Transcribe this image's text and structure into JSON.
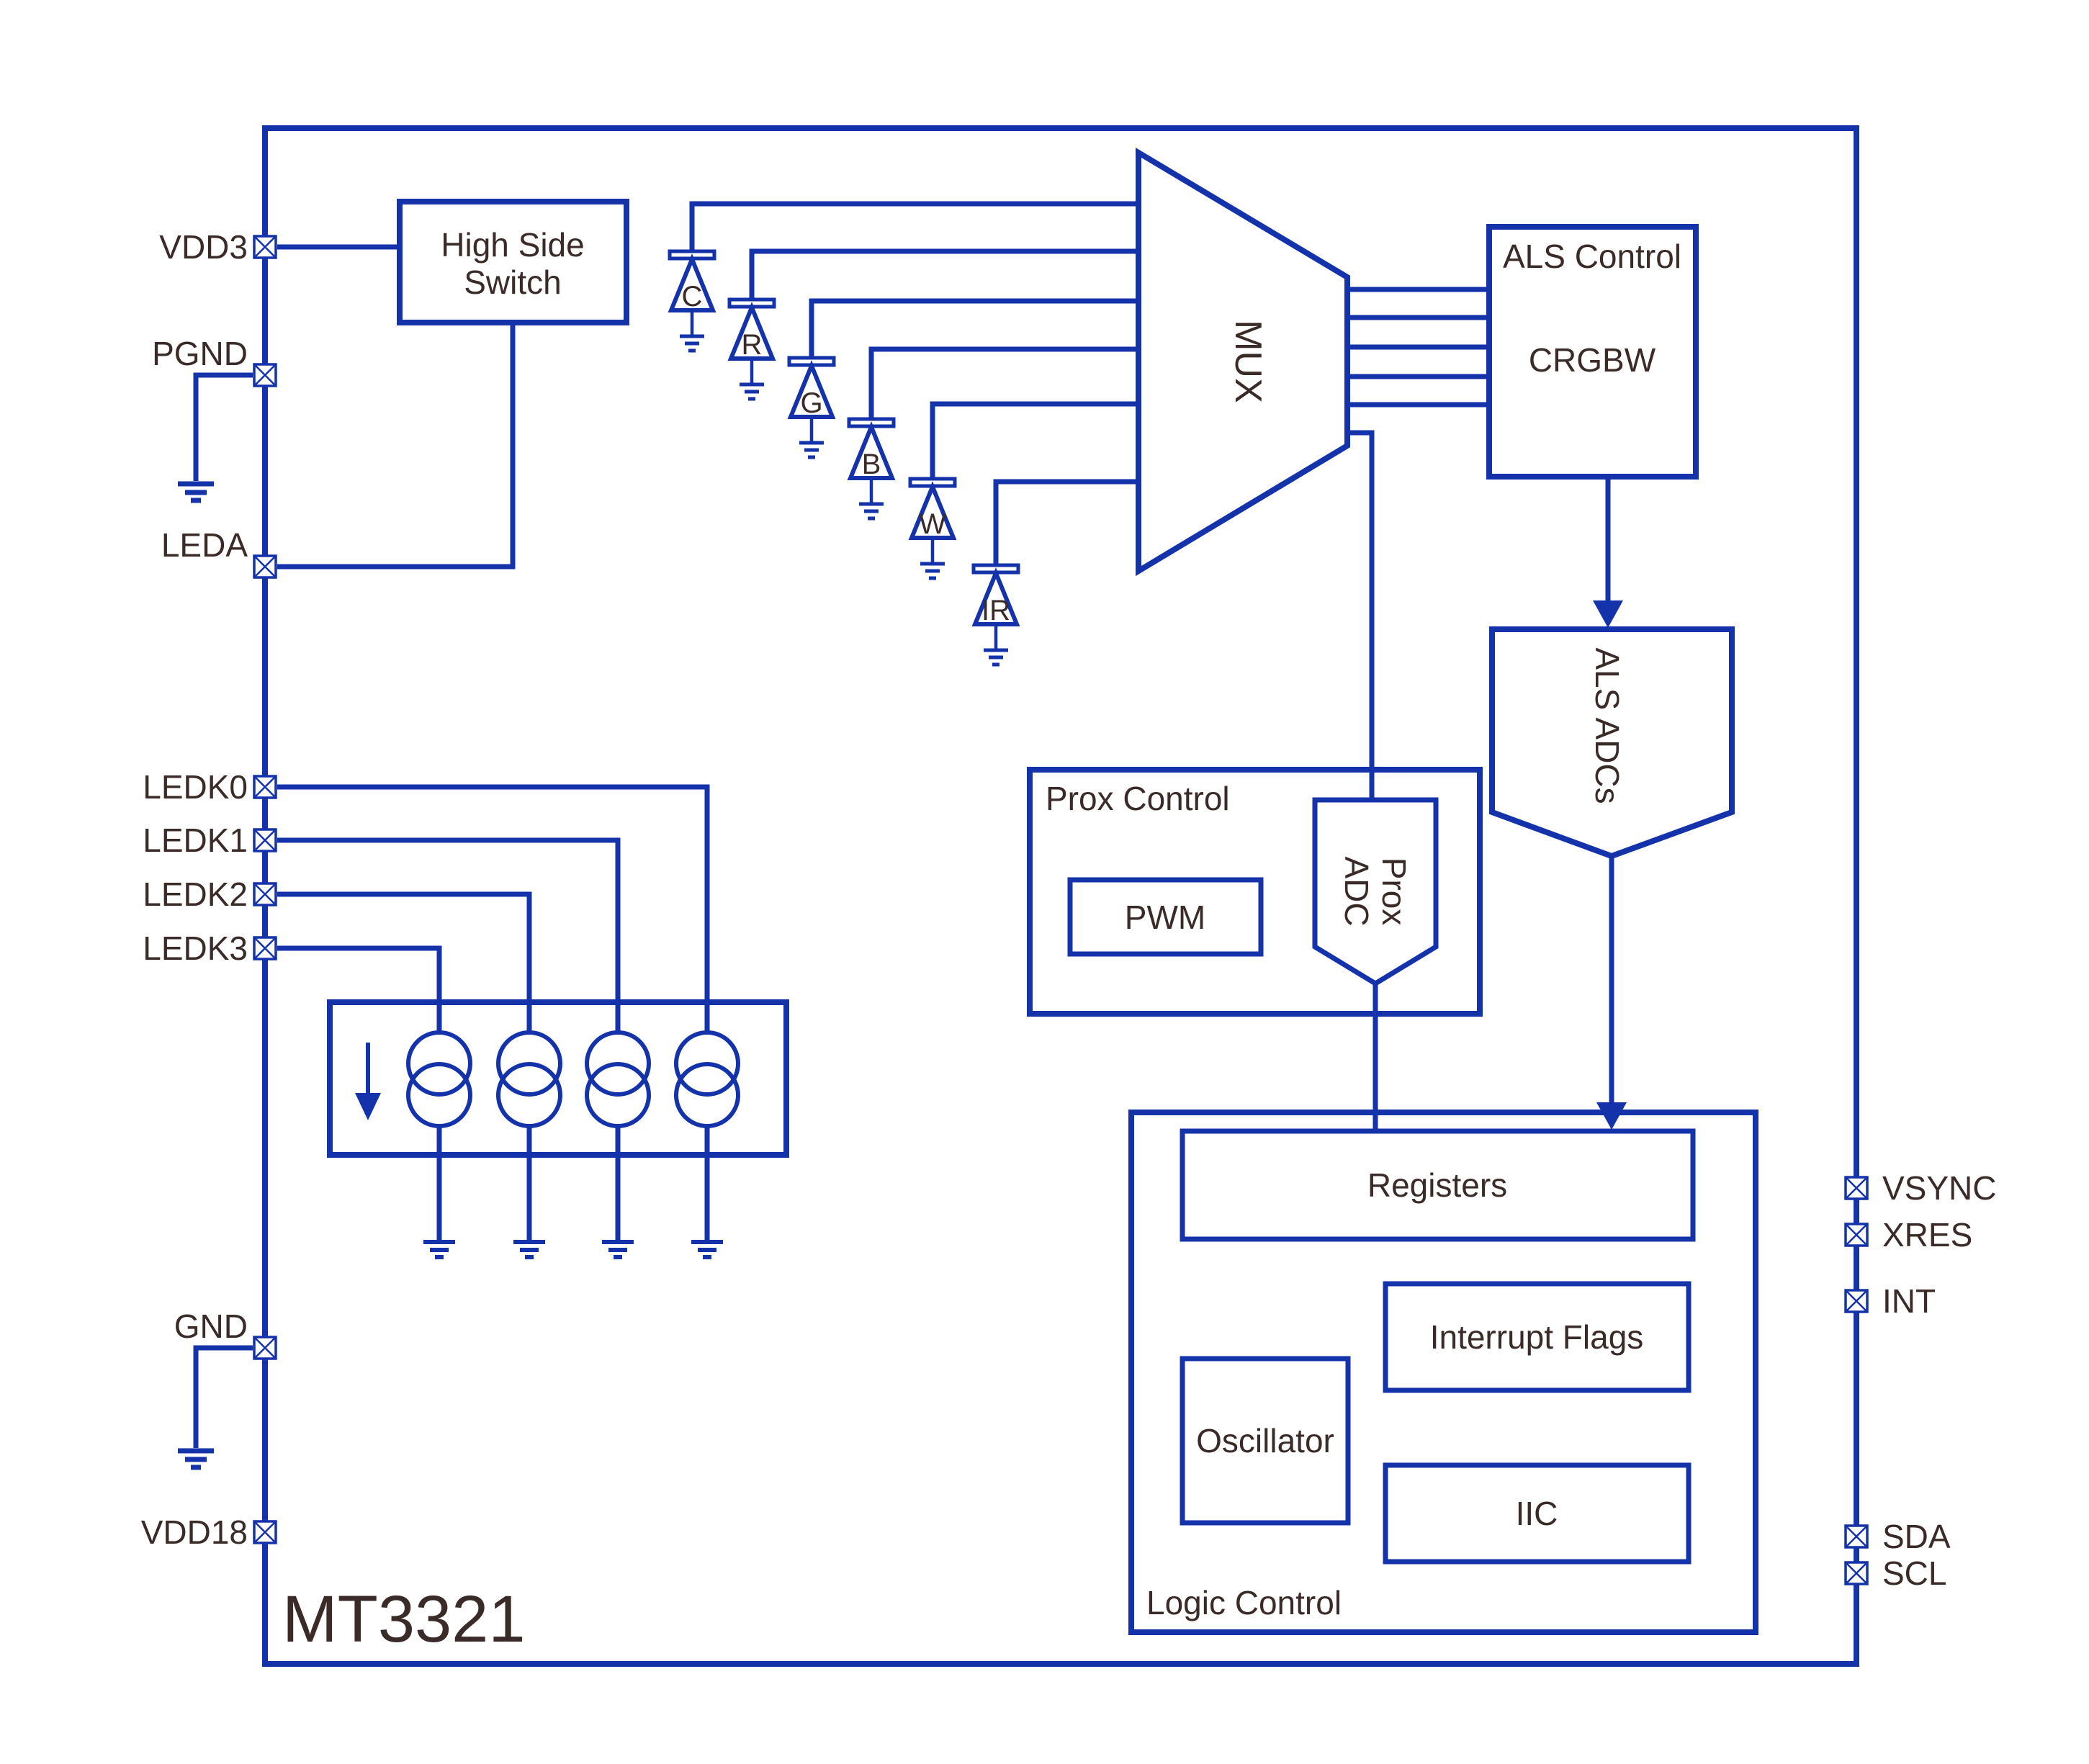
{
  "chip": {
    "name": "MT3321"
  },
  "colors": {
    "line_blue": "#1433aa",
    "text_dark": "#3a2b28",
    "diode_red": "#c1272d",
    "diode_green": "#009944",
    "diode_blue": "#1d7fd1"
  },
  "pins": {
    "left": [
      {
        "label": "VDD3"
      },
      {
        "label": "PGND"
      },
      {
        "label": "LEDA"
      },
      {
        "label": "LEDK0"
      },
      {
        "label": "LEDK1"
      },
      {
        "label": "LEDK2"
      },
      {
        "label": "LEDK3"
      },
      {
        "label": "GND"
      },
      {
        "label": "VDD18"
      }
    ],
    "right": [
      {
        "label": "VSYNC"
      },
      {
        "label": "XRES"
      },
      {
        "label": "INT"
      },
      {
        "label": "SDA"
      },
      {
        "label": "SCL"
      }
    ]
  },
  "blocks": {
    "high_side_switch": {
      "line1": "High Side",
      "line2": "Switch"
    },
    "mux": {
      "label": "MUX"
    },
    "als_control": {
      "title": "ALS Control",
      "body": "CRGBW"
    },
    "als_adcs": {
      "label": "ALS ADCs"
    },
    "prox_control": {
      "title": "Prox Control"
    },
    "pwm": {
      "label": "PWM"
    },
    "prox_adc": {
      "line1": "Prox",
      "line2": "ADC"
    },
    "logic_control": {
      "title": "Logic Control"
    },
    "registers": {
      "label": "Registers"
    },
    "interrupt_flags": {
      "label": "Interrupt Flags"
    },
    "oscillator": {
      "label": "Oscillator"
    },
    "iic": {
      "label": "IIC"
    }
  },
  "photodiodes": [
    {
      "label": "C",
      "color": "#3a2b28"
    },
    {
      "label": "R",
      "color": "#c1272d"
    },
    {
      "label": "G",
      "color": "#009944"
    },
    {
      "label": "B",
      "color": "#1d7fd1"
    },
    {
      "label": "W",
      "color": "#3a2b28"
    },
    {
      "label": "IR",
      "color": "#3a2b28"
    }
  ]
}
